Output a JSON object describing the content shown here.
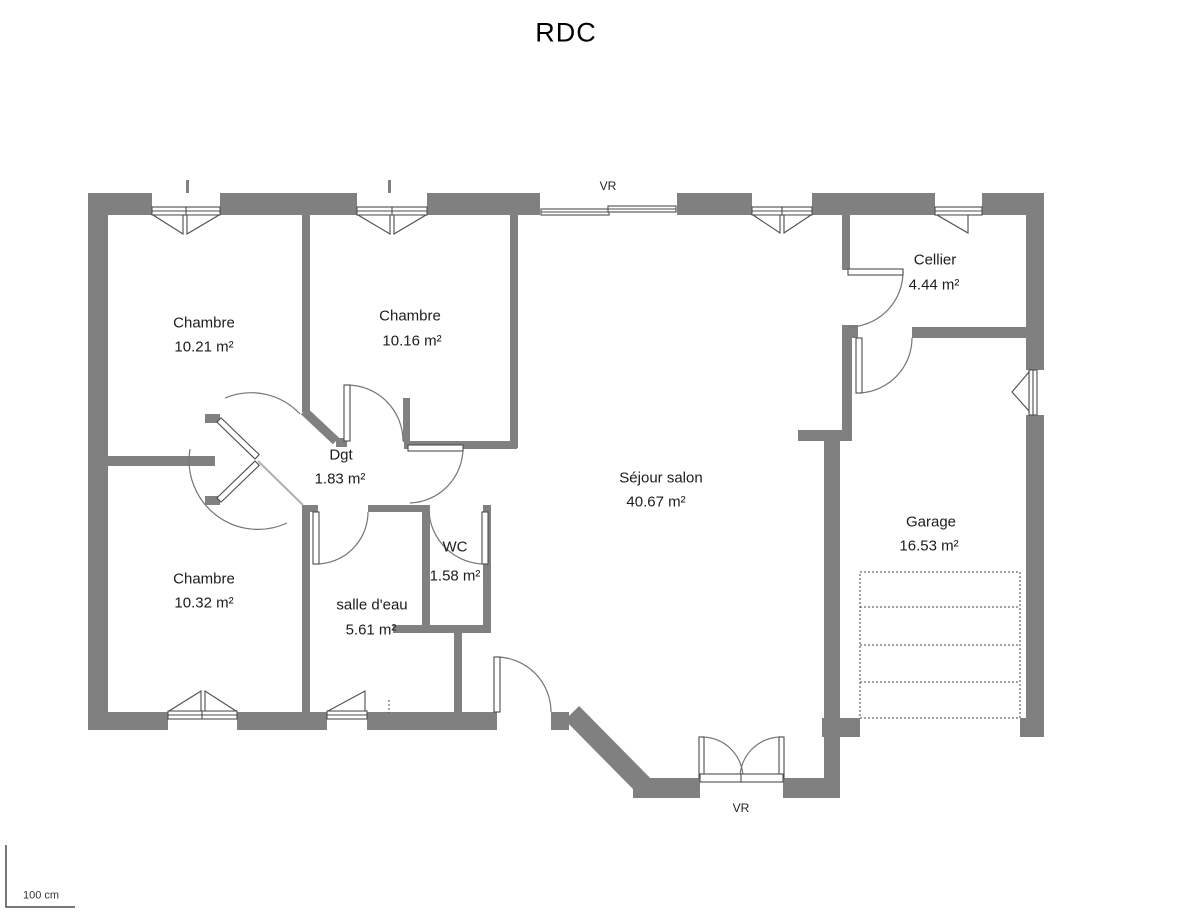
{
  "title": "RDC",
  "rooms": [
    {
      "name": "Chambre",
      "area": "10.21 m²"
    },
    {
      "name": "Chambre",
      "area": "10.16 m²"
    },
    {
      "name": "Chambre",
      "area": "10.32 m²"
    },
    {
      "name": "Dgt",
      "area": "1.83 m²"
    },
    {
      "name": "WC",
      "area": "1.58 m²"
    },
    {
      "name": "salle d'eau",
      "area": "5.61 m²"
    },
    {
      "name": "Séjour salon",
      "area": "40.67 m²"
    },
    {
      "name": "Cellier",
      "area": "4.44 m²"
    },
    {
      "name": "Garage",
      "area": "16.53 m²"
    }
  ],
  "annotations": {
    "vr_top": "VR",
    "vr_bottom": "VR",
    "scale_label": "100 cm"
  },
  "colors": {
    "wall": "#808080",
    "line": "#4d4d4d",
    "arc": "#757575",
    "text": "#1c1c1c"
  }
}
